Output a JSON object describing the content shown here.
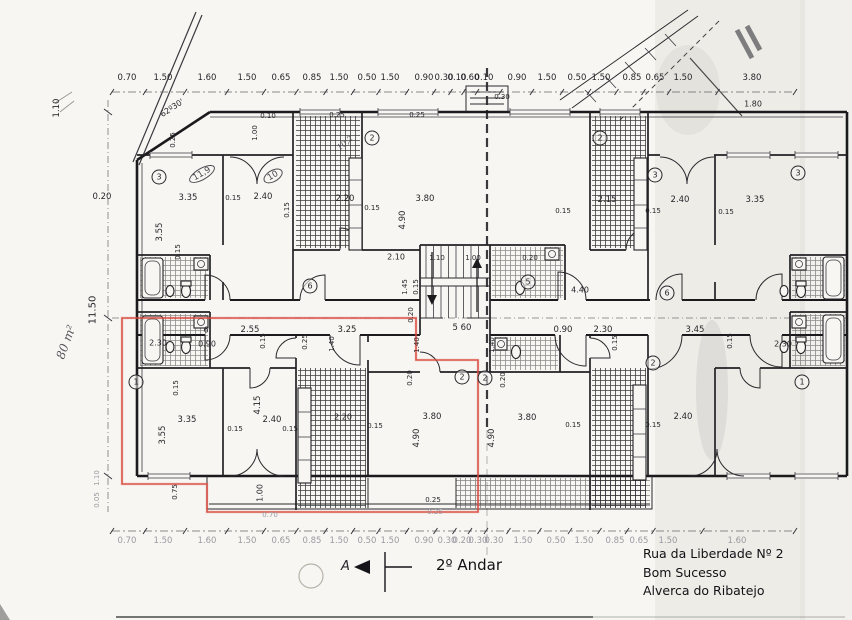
{
  "meta": {
    "sheet_title": "2º Andar",
    "address_line1": "Rua da Liberdade Nº 2",
    "address_line2": "Bom Sucesso",
    "address_line3": "Alverca do Ribatejo",
    "section_marker": "A",
    "area_note": "80 m²",
    "angle_note": "62º30'",
    "highlight_color": "#d8453a",
    "ink_color": "#1b1b1e",
    "paper_color": "#f7f6f2"
  },
  "plan": {
    "chains": [
      {
        "name": "top-dimension-chain",
        "y_text": 78,
        "y_line": 92,
        "x_start": 112,
        "x_end": 795,
        "labels": [
          {
            "x": 127,
            "t": "0.70"
          },
          {
            "x": 163,
            "t": "1.50"
          },
          {
            "x": 207,
            "t": "1.60"
          },
          {
            "x": 247,
            "t": "1.50"
          },
          {
            "x": 281,
            "t": "0.65"
          },
          {
            "x": 312,
            "t": "0.85"
          },
          {
            "x": 339,
            "t": "1.50"
          },
          {
            "x": 367,
            "t": "0.50"
          },
          {
            "x": 390,
            "t": "1.50"
          },
          {
            "x": 424,
            "t": "0.90"
          },
          {
            "x": 444,
            "t": "0.30"
          },
          {
            "x": 457,
            "t": "0.10"
          },
          {
            "x": 470,
            "t": "0.60"
          },
          {
            "x": 484,
            "t": "0.10"
          },
          {
            "x": 517,
            "t": "0.90"
          },
          {
            "x": 547,
            "t": "1.50"
          },
          {
            "x": 577,
            "t": "0.50"
          },
          {
            "x": 601,
            "t": "1.50"
          },
          {
            "x": 632,
            "t": "0.85"
          },
          {
            "x": 655,
            "t": "0.65"
          },
          {
            "x": 683,
            "t": "1.50"
          },
          {
            "x": 752,
            "t": "3.80"
          }
        ]
      },
      {
        "name": "bottom-dimension-chain",
        "y_text": 541,
        "y_line": 531,
        "x_start": 112,
        "x_end": 795,
        "c": "faint",
        "labels": [
          {
            "x": 127,
            "t": "0.70"
          },
          {
            "x": 163,
            "t": "1.50"
          },
          {
            "x": 207,
            "t": "1.60"
          },
          {
            "x": 247,
            "t": "1.50"
          },
          {
            "x": 281,
            "t": "0.65"
          },
          {
            "x": 312,
            "t": "0.85"
          },
          {
            "x": 339,
            "t": "1.50"
          },
          {
            "x": 367,
            "t": "0.50"
          },
          {
            "x": 390,
            "t": "1.50"
          },
          {
            "x": 424,
            "t": "0.90"
          },
          {
            "x": 447,
            "t": "0.30"
          },
          {
            "x": 462,
            "t": "0.20"
          },
          {
            "x": 478,
            "t": "0.30"
          },
          {
            "x": 494,
            "t": "0.30"
          },
          {
            "x": 523,
            "t": "1.50"
          },
          {
            "x": 556,
            "t": "0.50"
          },
          {
            "x": 584,
            "t": "1.50"
          },
          {
            "x": 615,
            "t": "0.85"
          },
          {
            "x": 639,
            "t": "0.65"
          },
          {
            "x": 668,
            "t": "1.50"
          },
          {
            "x": 737,
            "t": "1.60"
          }
        ]
      }
    ],
    "labels": [
      {
        "name": "left-dim",
        "x": 57,
        "y": 108,
        "t": "1.10",
        "r": -90
      },
      {
        "x": 102,
        "y": 197,
        "t": "0.20"
      },
      {
        "name": "left-height-dim",
        "x": 93,
        "y": 310,
        "t": "11.50",
        "r": -90,
        "s": 10
      },
      {
        "name": "area-annotation",
        "x": 66,
        "y": 342,
        "t": "80 m²",
        "r": -70,
        "c": "hand",
        "s": 12
      },
      {
        "x": 97,
        "y": 478,
        "t": "1.10",
        "r": -90,
        "s": 7,
        "c": "faint"
      },
      {
        "x": 97,
        "y": 500,
        "t": "0.05",
        "r": -90,
        "s": 7,
        "c": "faint"
      },
      {
        "name": "angle-annotation",
        "x": 172,
        "y": 108,
        "t": "62º30'",
        "r": -33,
        "s": 8
      },
      {
        "x": 173,
        "y": 140,
        "t": "0.25",
        "r": -90,
        "s": 7
      },
      {
        "x": 255,
        "y": 133,
        "t": "1.00",
        "r": -90,
        "s": 7
      },
      {
        "x": 268,
        "y": 116,
        "t": "0.10",
        "s": 7
      },
      {
        "x": 337,
        "y": 115,
        "t": "0.25",
        "s": 7
      },
      {
        "x": 417,
        "y": 115,
        "t": "0.25",
        "s": 7
      },
      {
        "x": 502,
        "y": 97,
        "t": "0.30",
        "s": 7
      },
      {
        "name": "room-number",
        "x": 159,
        "y": 177,
        "t": "3",
        "c": "circ"
      },
      {
        "name": "room-area-note",
        "x": 202,
        "y": 174,
        "t": "11,9",
        "c": "oval",
        "r": -30
      },
      {
        "name": "room-area-note",
        "x": 273,
        "y": 176,
        "t": "10",
        "c": "oval",
        "r": -30
      },
      {
        "name": "room-area-note",
        "x": 345,
        "y": 143,
        "t": "10,2",
        "c": "hand",
        "r": -40,
        "s": 8
      },
      {
        "x": 188,
        "y": 198,
        "t": "3.35"
      },
      {
        "x": 233,
        "y": 198,
        "t": "0.15",
        "s": 7
      },
      {
        "x": 263,
        "y": 197,
        "t": "2.40"
      },
      {
        "x": 160,
        "y": 232,
        "t": "3.55",
        "r": -90
      },
      {
        "x": 178,
        "y": 252,
        "t": "0.15",
        "r": -90,
        "s": 7
      },
      {
        "x": 287,
        "y": 210,
        "t": "0.15",
        "r": -90,
        "s": 7
      },
      {
        "x": 345,
        "y": 199,
        "t": "2.20"
      },
      {
        "x": 372,
        "y": 208,
        "t": "0.15",
        "s": 7
      },
      {
        "x": 425,
        "y": 199,
        "t": "3.80"
      },
      {
        "x": 403,
        "y": 220,
        "t": "4.90",
        "r": -90
      },
      {
        "name": "room-number",
        "x": 372,
        "y": 138,
        "t": "2",
        "c": "circ"
      },
      {
        "x": 396,
        "y": 257,
        "t": "2.10",
        "s": 8
      },
      {
        "x": 437,
        "y": 258,
        "t": "1.10",
        "s": 7
      },
      {
        "x": 473,
        "y": 258,
        "t": "1.00",
        "s": 7
      },
      {
        "x": 530,
        "y": 258,
        "t": "0.20",
        "s": 7
      },
      {
        "x": 405,
        "y": 287,
        "t": "1.45",
        "r": -90,
        "s": 7
      },
      {
        "x": 416,
        "y": 287,
        "t": "0.15",
        "r": -90,
        "s": 7
      },
      {
        "x": 411,
        "y": 315,
        "t": "0.20",
        "r": -90,
        "s": 7
      },
      {
        "name": "room-number",
        "x": 310,
        "y": 286,
        "t": "6",
        "c": "circ"
      },
      {
        "name": "room-number",
        "x": 600,
        "y": 138,
        "t": "2",
        "c": "circ"
      },
      {
        "name": "room-number",
        "x": 528,
        "y": 282,
        "t": "5",
        "c": "circ"
      },
      {
        "x": 580,
        "y": 290,
        "t": "4.40",
        "s": 8
      },
      {
        "name": "room-number",
        "x": 667,
        "y": 293,
        "t": "6",
        "c": "circ"
      },
      {
        "x": 607,
        "y": 200,
        "t": "2.15"
      },
      {
        "x": 680,
        "y": 200,
        "t": "2.40"
      },
      {
        "x": 755,
        "y": 200,
        "t": "3.35"
      },
      {
        "x": 563,
        "y": 211,
        "t": "0.15",
        "s": 7
      },
      {
        "x": 653,
        "y": 211,
        "t": "0.15",
        "s": 7
      },
      {
        "x": 726,
        "y": 212,
        "t": "0.15",
        "s": 7
      },
      {
        "name": "room-number",
        "x": 655,
        "y": 175,
        "t": "3",
        "c": "circ"
      },
      {
        "name": "room-number",
        "x": 798,
        "y": 173,
        "t": "3",
        "c": "circ"
      },
      {
        "x": 753,
        "y": 104,
        "t": "1.80",
        "s": 8
      },
      {
        "x": 206,
        "y": 330,
        "t": "6",
        "s": 8
      },
      {
        "x": 250,
        "y": 330,
        "t": "2.55"
      },
      {
        "x": 347,
        "y": 330,
        "t": "3.25"
      },
      {
        "name": "stair-dim",
        "x": 462,
        "y": 328,
        "t": "5 60"
      },
      {
        "x": 563,
        "y": 330,
        "t": "0.90"
      },
      {
        "x": 603,
        "y": 330,
        "t": "2.30"
      },
      {
        "x": 695,
        "y": 330,
        "t": "3.45"
      },
      {
        "x": 207,
        "y": 344,
        "t": "0.90",
        "s": 8
      },
      {
        "x": 158,
        "y": 343,
        "t": "2.30",
        "s": 8
      },
      {
        "x": 783,
        "y": 344,
        "t": "2.30",
        "s": 8
      },
      {
        "x": 263,
        "y": 341,
        "t": "0.15",
        "r": -90,
        "s": 7
      },
      {
        "x": 305,
        "y": 342,
        "t": "0.25",
        "r": -90,
        "s": 7
      },
      {
        "x": 332,
        "y": 344,
        "t": "1.40",
        "r": -90,
        "s": 7
      },
      {
        "x": 417,
        "y": 345,
        "t": "1.40",
        "r": -90,
        "s": 7
      },
      {
        "x": 492,
        "y": 345,
        "t": "1.40",
        "r": -90,
        "s": 7
      },
      {
        "x": 615,
        "y": 343,
        "t": "0.15",
        "r": -90,
        "s": 7
      },
      {
        "x": 730,
        "y": 341,
        "t": "0.15",
        "r": -90,
        "s": 7
      },
      {
        "name": "room-number",
        "x": 136,
        "y": 382,
        "t": "1",
        "c": "circ"
      },
      {
        "x": 176,
        "y": 388,
        "t": "0.15",
        "r": -90,
        "s": 7
      },
      {
        "x": 187,
        "y": 420,
        "t": "3.35"
      },
      {
        "x": 163,
        "y": 435,
        "t": "3.55",
        "r": -90
      },
      {
        "x": 235,
        "y": 429,
        "t": "0.15",
        "s": 7
      },
      {
        "x": 272,
        "y": 420,
        "t": "2.40"
      },
      {
        "x": 258,
        "y": 405,
        "t": "4.15",
        "r": -90
      },
      {
        "x": 290,
        "y": 429,
        "t": "0.15",
        "s": 7
      },
      {
        "x": 175,
        "y": 492,
        "t": "0.75",
        "r": -90,
        "s": 7
      },
      {
        "x": 260,
        "y": 493,
        "t": "1.00",
        "r": -90,
        "s": 8
      },
      {
        "x": 270,
        "y": 515,
        "t": "0.70",
        "s": 7,
        "c": "faint"
      },
      {
        "x": 410,
        "y": 378,
        "t": "0.20",
        "r": -90,
        "s": 7
      },
      {
        "name": "room-number",
        "x": 462,
        "y": 377,
        "t": "2",
        "c": "circ"
      },
      {
        "name": "room-number",
        "x": 485,
        "y": 378,
        "t": "2",
        "c": "circ"
      },
      {
        "x": 343,
        "y": 417,
        "t": "2.20",
        "s": 8
      },
      {
        "x": 375,
        "y": 426,
        "t": "0.15",
        "s": 7
      },
      {
        "x": 432,
        "y": 417,
        "t": "3.80"
      },
      {
        "x": 417,
        "y": 438,
        "t": "4.90",
        "r": -90
      },
      {
        "x": 433,
        "y": 500,
        "t": "0.25",
        "s": 7
      },
      {
        "x": 435,
        "y": 512,
        "t": "0.25",
        "s": 7,
        "c": "faint"
      },
      {
        "x": 503,
        "y": 380,
        "t": "0.20",
        "r": -90,
        "s": 7
      },
      {
        "x": 527,
        "y": 418,
        "t": "3.80"
      },
      {
        "x": 492,
        "y": 438,
        "t": "4.90",
        "r": -90
      },
      {
        "x": 573,
        "y": 425,
        "t": "0.15",
        "s": 7
      },
      {
        "name": "room-number",
        "x": 653,
        "y": 363,
        "t": "2",
        "c": "circ"
      },
      {
        "x": 683,
        "y": 417,
        "t": "2.40"
      },
      {
        "x": 653,
        "y": 425,
        "t": "0.15",
        "s": 7
      },
      {
        "name": "room-number",
        "x": 802,
        "y": 382,
        "t": "1",
        "c": "circ"
      }
    ]
  }
}
